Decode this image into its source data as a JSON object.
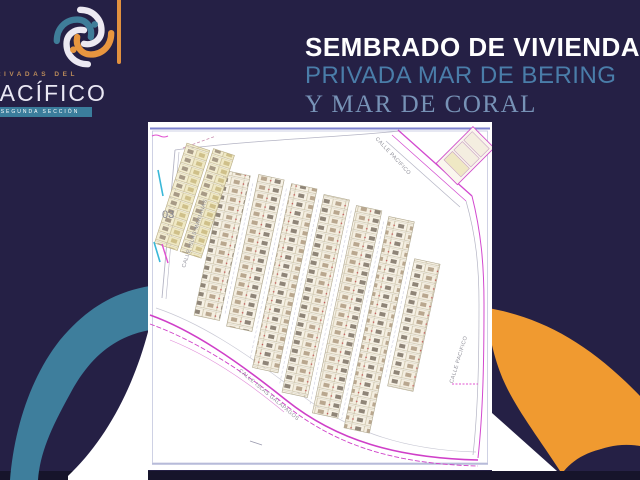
{
  "header": {
    "title_line1": "SEMBRADO DE VIVIENDA",
    "title_line2": "PRIVADA MAR DE BERING",
    "title_line3": "Y MAR DE CORAL"
  },
  "logo": {
    "top_text": "PRIVADAS DEL",
    "name": "PACÍFICO",
    "sub_text": "SEGUNDA SECCIÓN"
  },
  "map": {
    "zone_label": "03",
    "streets": {
      "left": "CALLE ISLAS MARIANAS",
      "top_right": "CALLE PACIFICO",
      "right": "CALLE PACIFICO",
      "bottom": "CALLE ISLAS GALAPAGOS"
    }
  },
  "colors": {
    "navy": "#252045",
    "teal": "#3e7e9c",
    "orange": "#f09a30",
    "bottom_bar": "#16142b",
    "road_magenta": "#d83fd0",
    "title_blue": "#4a7da9",
    "title_light_blue": "#7792b6",
    "logo_accent_orange": "#e1913f"
  }
}
